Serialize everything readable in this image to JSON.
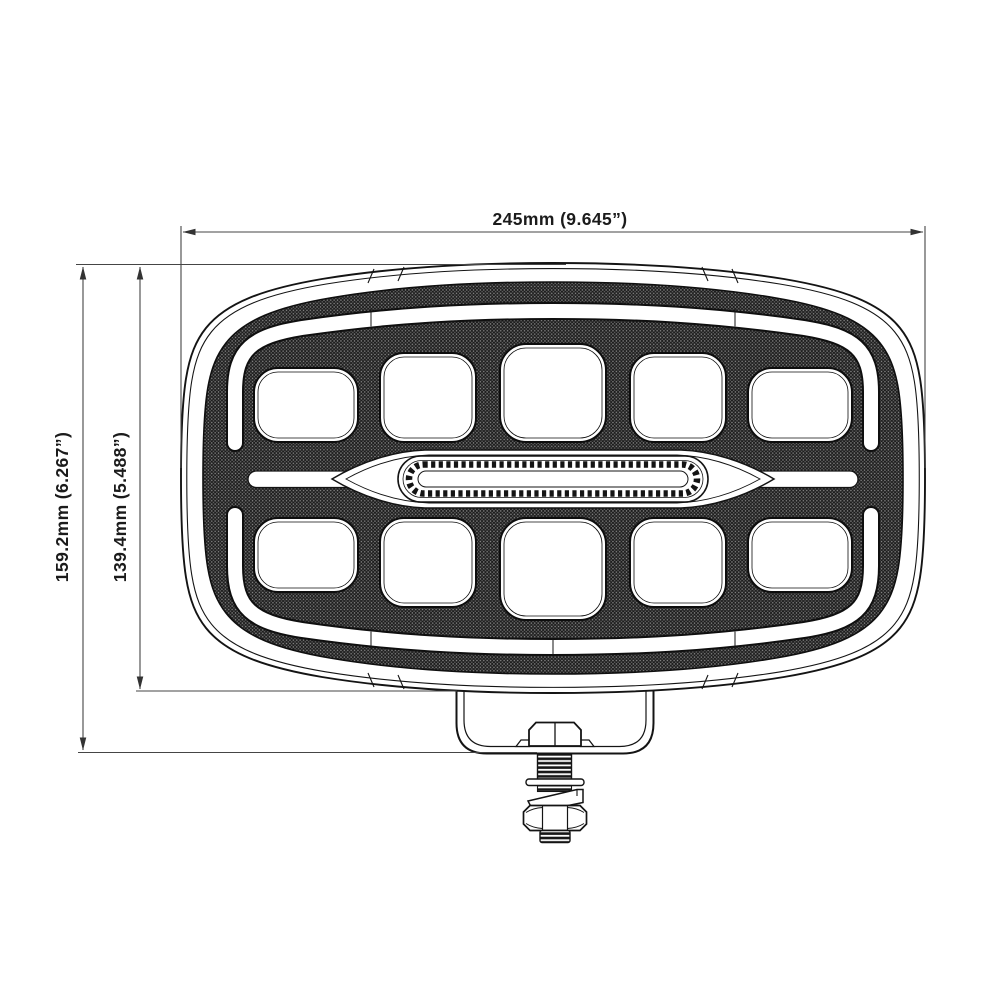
{
  "drawing": {
    "dimensions": {
      "width": {
        "label": "245mm (9.645”)"
      },
      "total_height": {
        "label": "159.2mm (6.267”)"
      },
      "body_height": {
        "label": "139.4mm (5.488”)"
      }
    },
    "colors": {
      "line": "#141414",
      "dimension_line": "#454545",
      "texture_base": "#1c1c1c",
      "texture_dot": "#8b8b8b",
      "background": "#ffffff"
    }
  }
}
